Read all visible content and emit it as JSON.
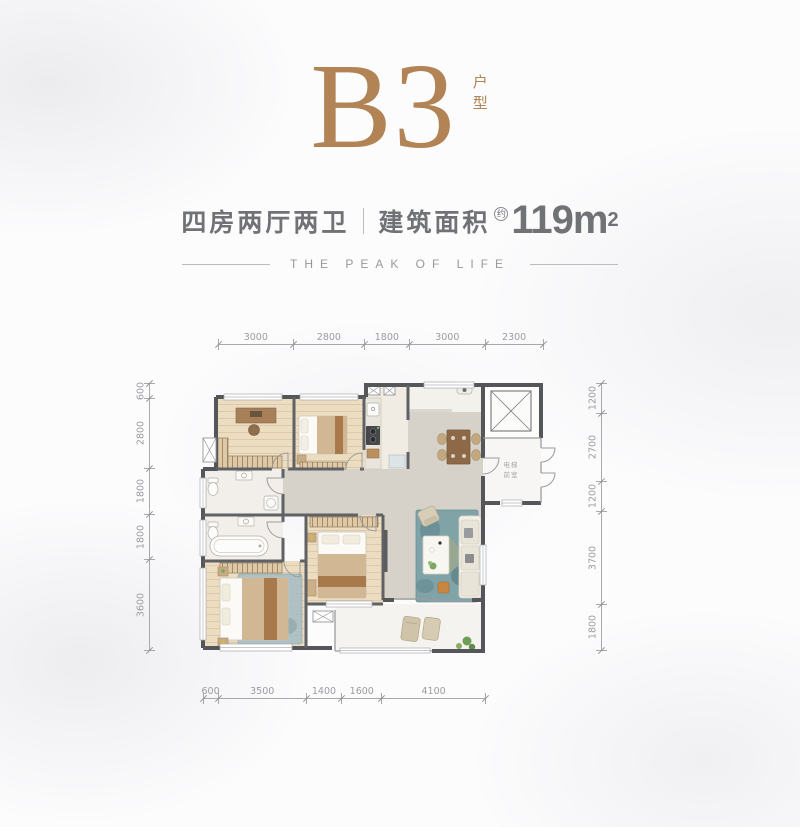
{
  "header": {
    "plan_code": "B3",
    "unit_label": "户型",
    "spec": "四房两厅两卫",
    "area_label": "建筑面积",
    "area_approx": "约",
    "area_value": "119m",
    "area_sup": "2",
    "tagline": "THE PEAK OF LIFE"
  },
  "plan": {
    "lobby_line1": "电梯",
    "lobby_line2": "前室"
  },
  "dimensions": {
    "top": [
      3000,
      2800,
      1800,
      3000,
      2300
    ],
    "bottom": [
      600,
      3500,
      1400,
      1600,
      4100
    ],
    "left": [
      600,
      2800,
      1800,
      1800,
      3600
    ],
    "right": [
      1200,
      2700,
      1200,
      3700,
      1800
    ]
  },
  "colors": {
    "accent": "#b18355",
    "text-dark": "#717276",
    "dim": "#a8a9ac",
    "wall": "#55565a",
    "wood": "#ecdcc0",
    "gray-floor": "#d6d2ca",
    "marble": "#f2efea",
    "rug": "#7fa3a6",
    "comb": "#ddc9a8",
    "blanket": "#d2b795",
    "runner": "#a8794b",
    "furn-brown": "#8d6947"
  }
}
